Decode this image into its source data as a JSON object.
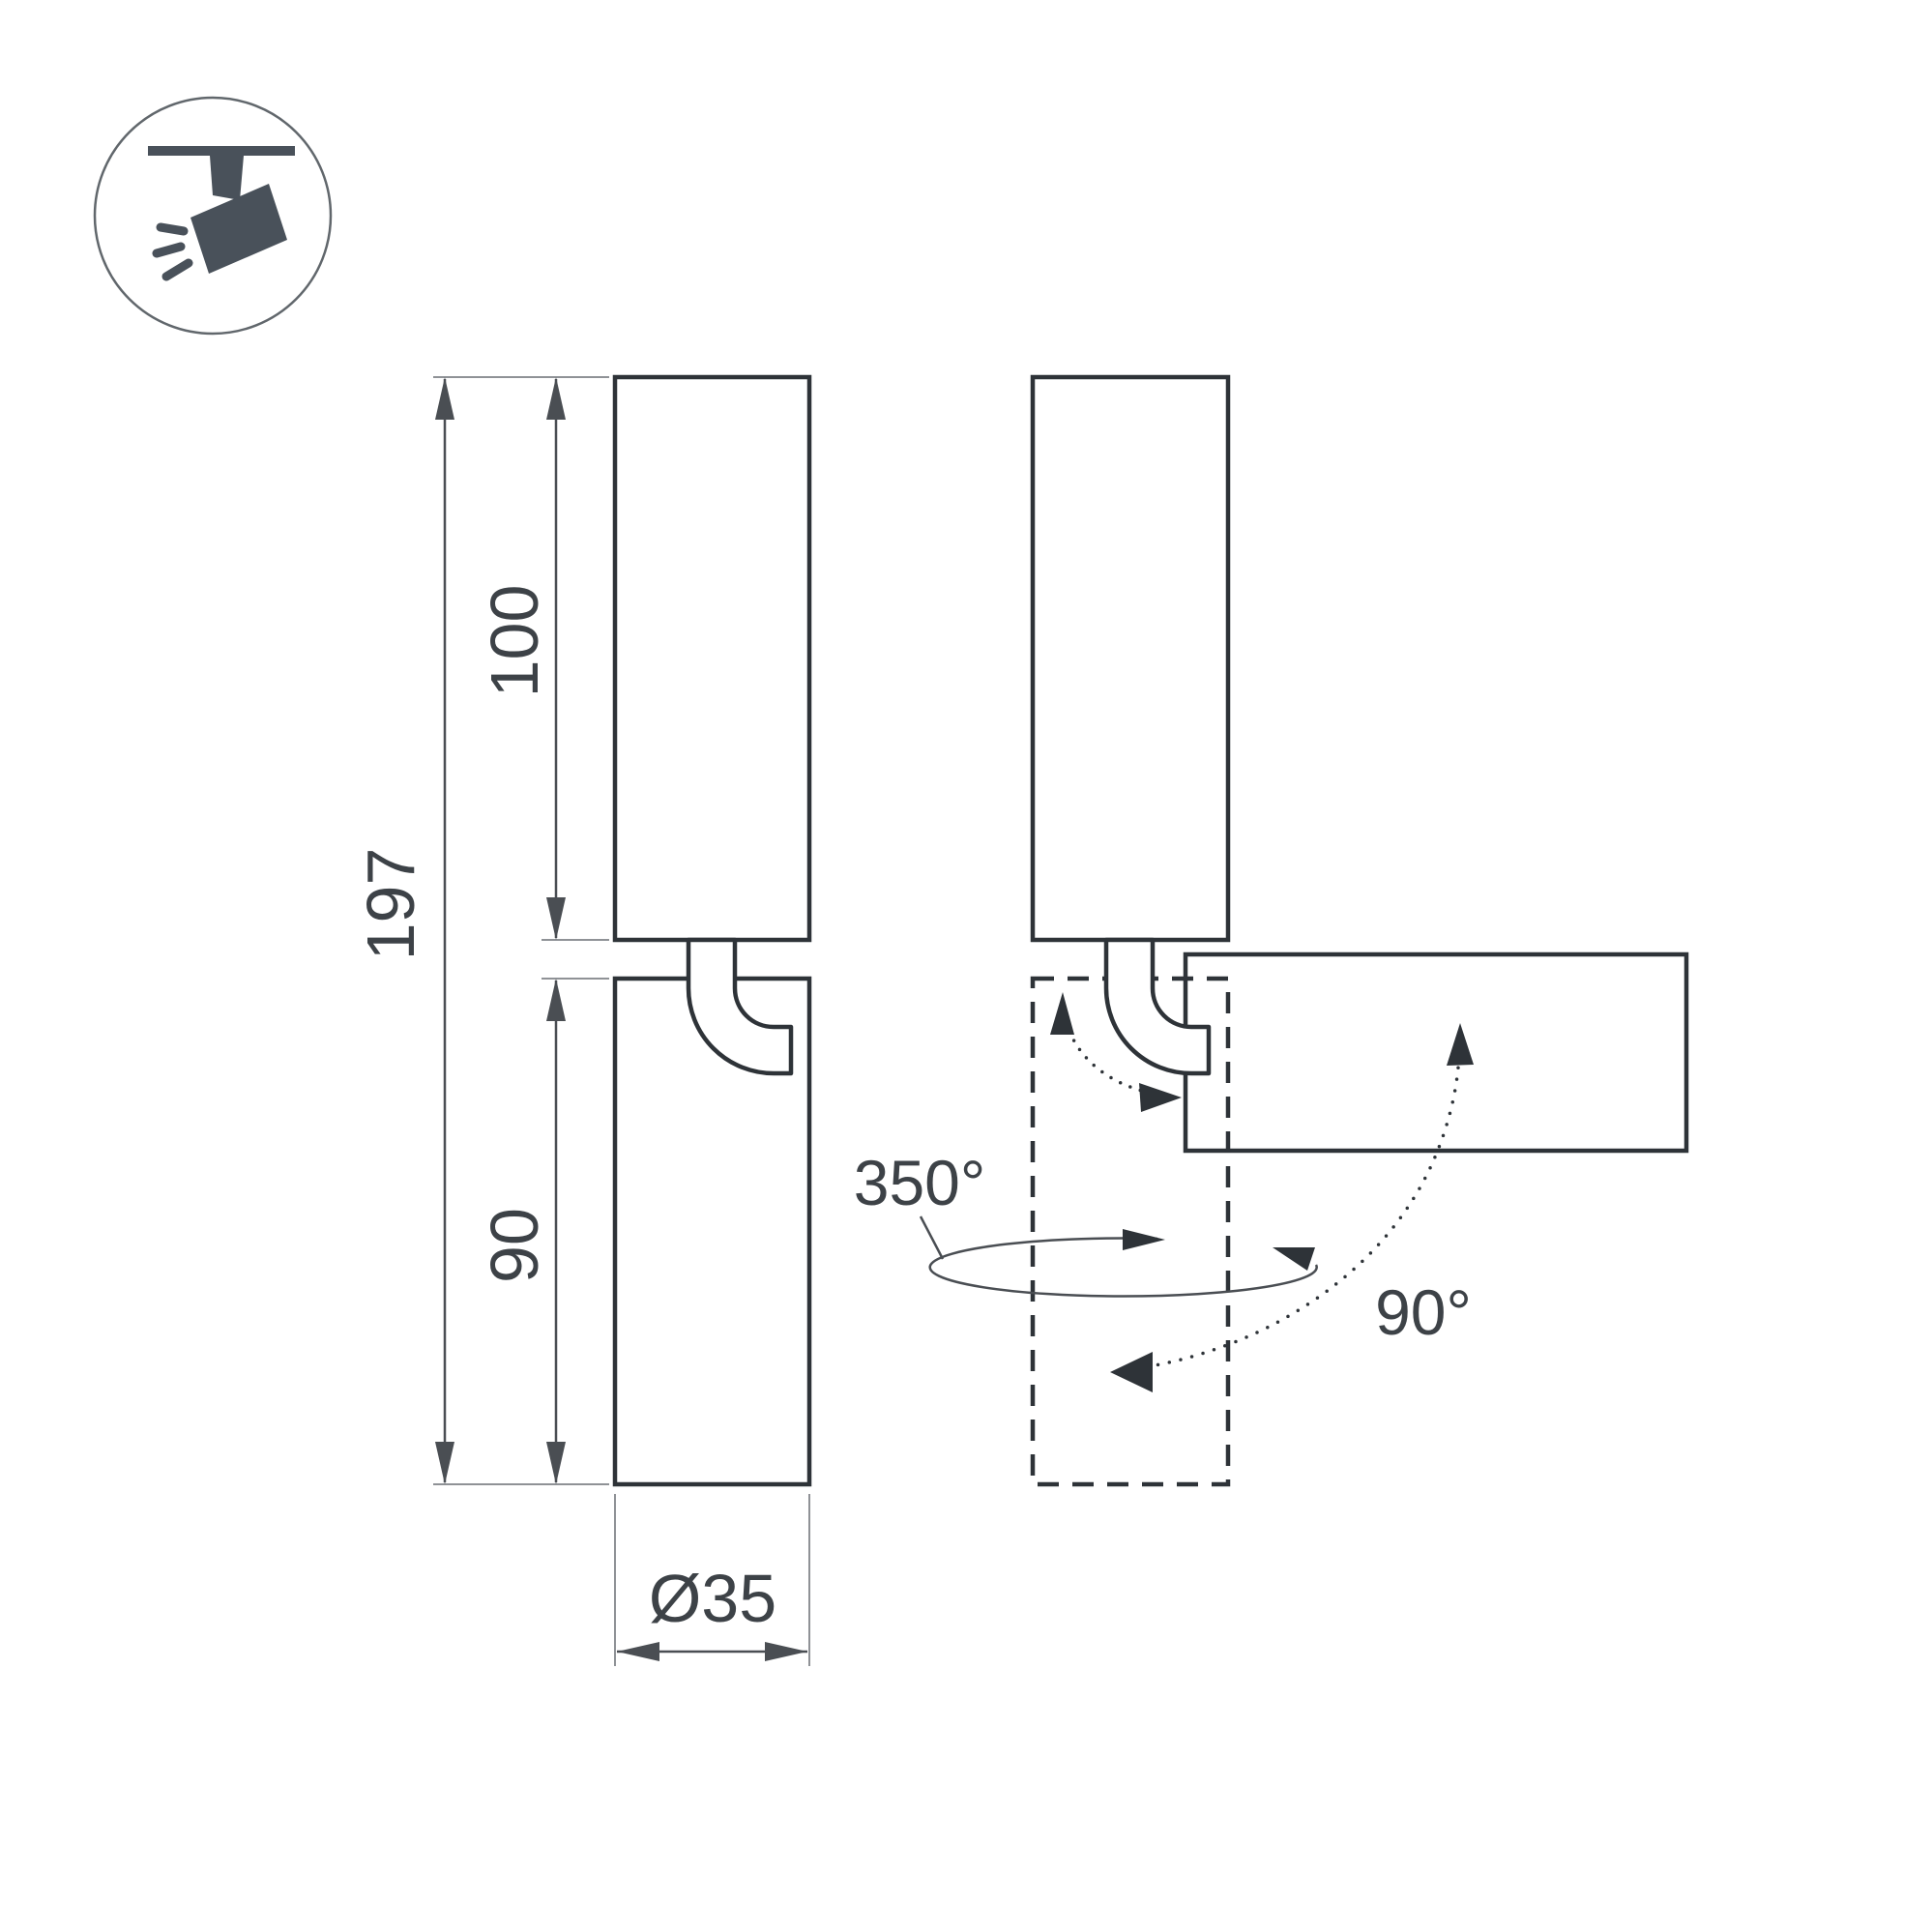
{
  "title": "Track spotlight dimension drawing",
  "colors": {
    "background": "#ffffff",
    "outline": "#2e3338",
    "dimension_line": "#4a4e53",
    "extension_line": "#8f9296",
    "label_text": "#3d4247",
    "icon": "#49515a",
    "icon_circle": "#61676c"
  },
  "icon": {
    "name": "ceiling-track-spotlight-icon"
  },
  "drawing": {
    "front_view": {
      "overall_height_label": "197",
      "upper_body_height_label": "100",
      "lower_body_height_label": "90",
      "diameter_label": "Ø35"
    },
    "rotation_view": {
      "pan_rotation_label": "350°",
      "tilt_rotation_label": "90°"
    }
  }
}
